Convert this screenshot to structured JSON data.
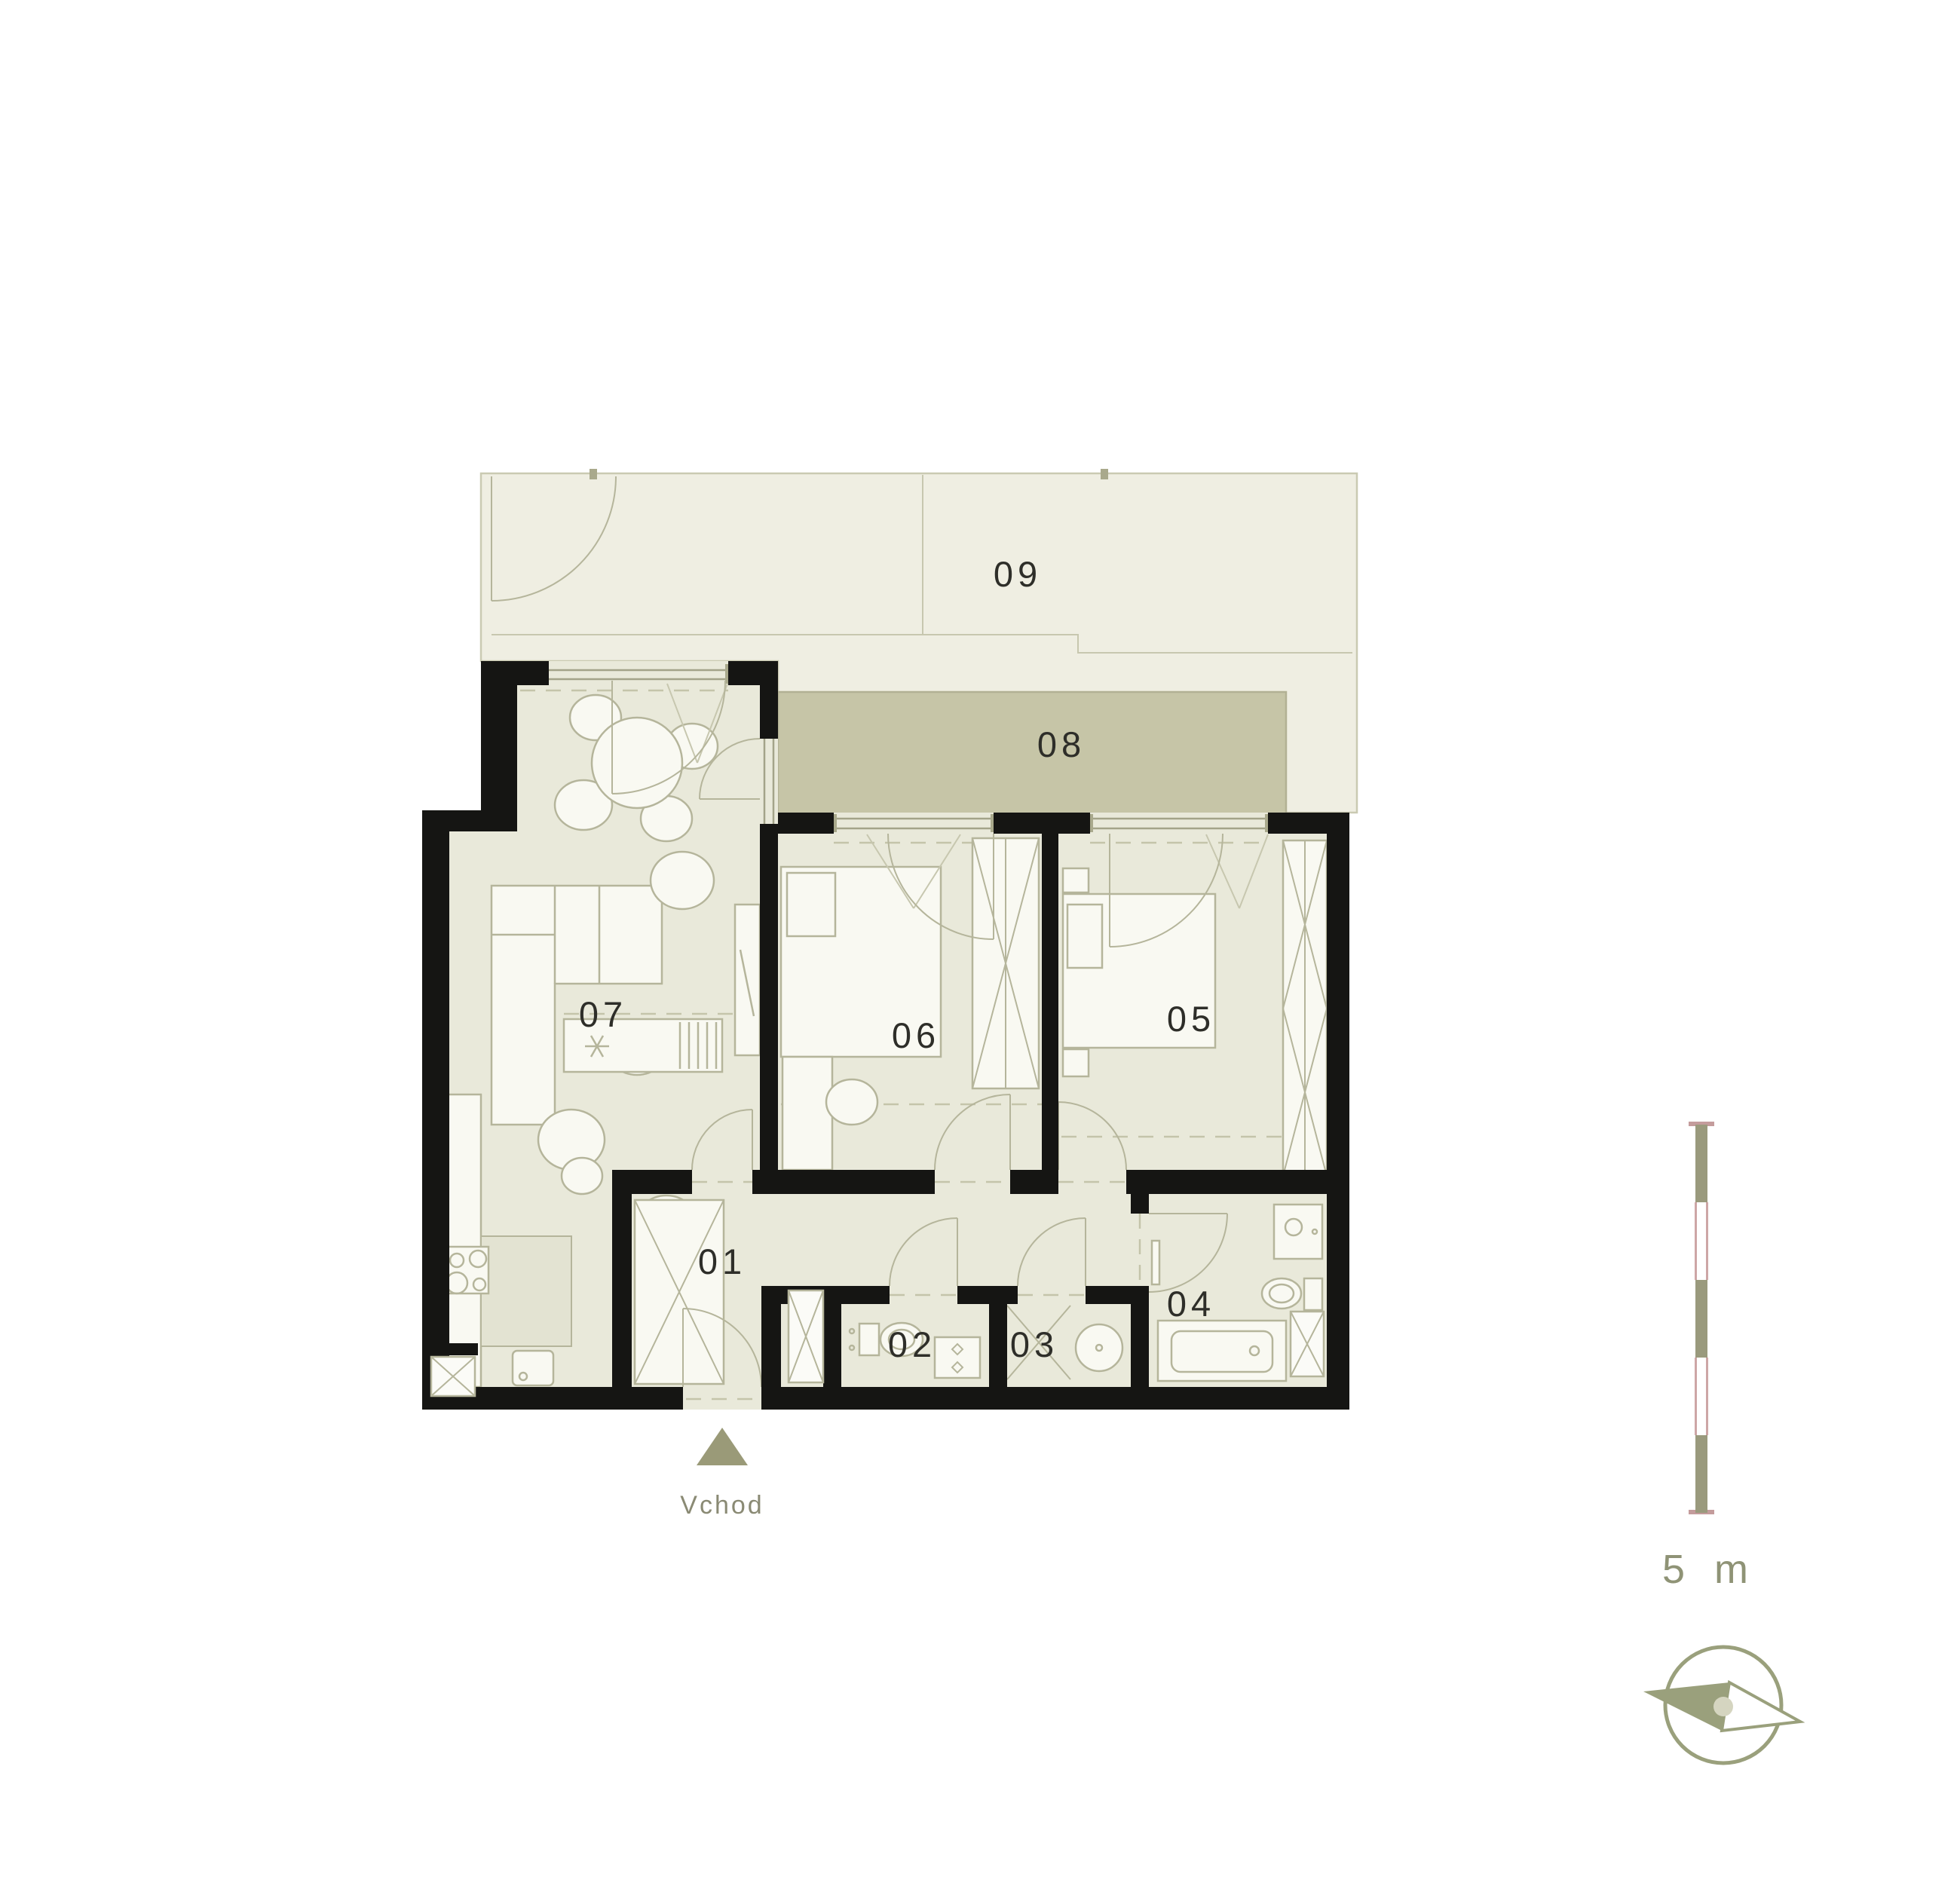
{
  "plan": {
    "rooms": {
      "r01": {
        "label": "01"
      },
      "r02": {
        "label": "02"
      },
      "r03": {
        "label": "03"
      },
      "r04": {
        "label": "04"
      },
      "r05": {
        "label": "05"
      },
      "r06": {
        "label": "06"
      },
      "r07": {
        "label": "07"
      },
      "r08": {
        "label": "08"
      },
      "r09": {
        "label": "09"
      }
    },
    "entrance": {
      "label": "Vchod"
    },
    "scale_bar": {
      "label": "5 m"
    },
    "colors": {
      "background": "#ffffff",
      "floor": "#e9e9da",
      "terrace": "#efeee2",
      "balcony": "#c6c5a7",
      "wall": "#151513",
      "furniture_line": "#b5b59b",
      "label_text": "#2e2e29",
      "olive_accent": "#9aa07c",
      "scale_pink": "#c49c9c"
    }
  }
}
